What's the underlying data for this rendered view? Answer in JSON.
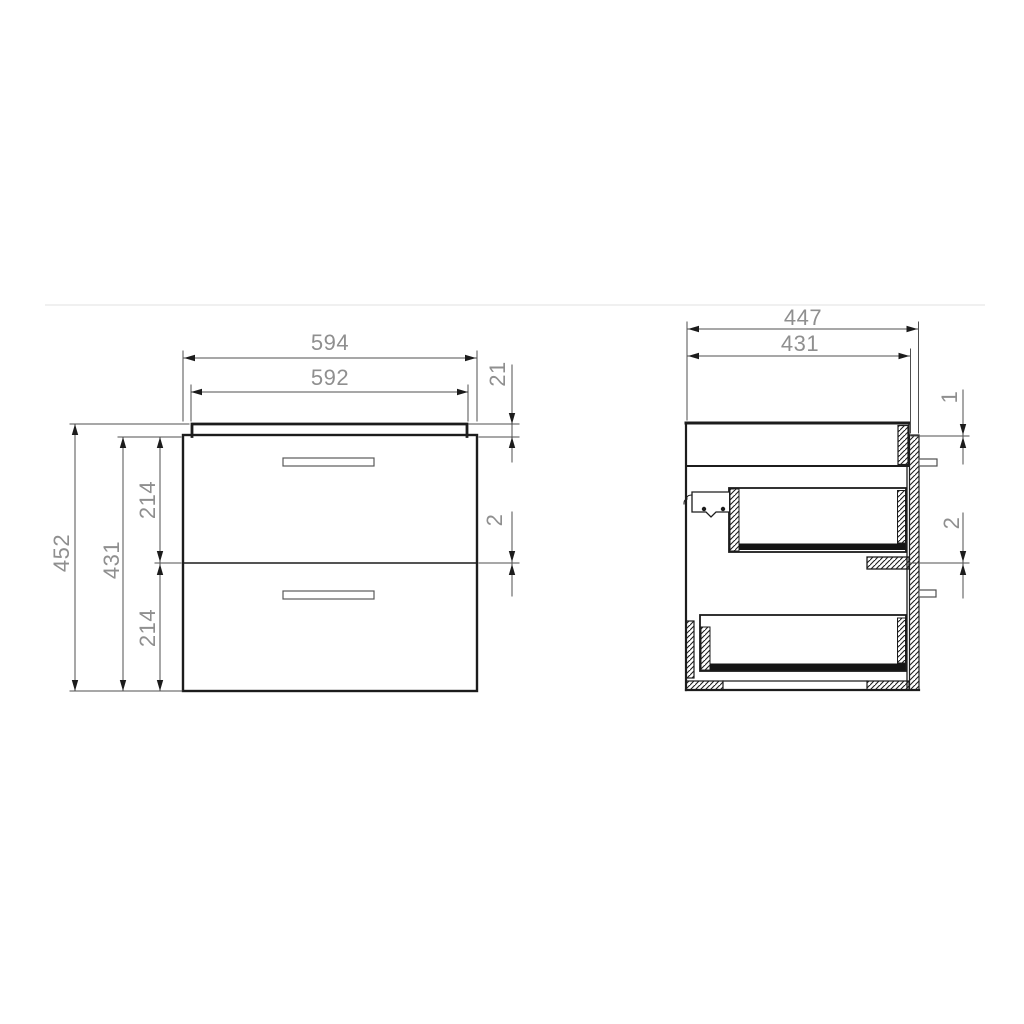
{
  "drawing": {
    "title": "two-drawer-cabinet-technical-drawing",
    "colors": {
      "outline": "#1c1c1c",
      "dim_line": "#4f4f4f",
      "dim_text": "#8f8f8f",
      "page_divider": "#f0f0f0",
      "background": "#ffffff"
    },
    "front_view": {
      "label": "front-view",
      "overall_width": "594",
      "top_panel_width": "592",
      "top_panel_height": "21",
      "drawer_gap": "2",
      "overall_height": "452",
      "carcass_height": "431",
      "upper_drawer_height": "214",
      "lower_drawer_height": "214"
    },
    "side_view": {
      "label": "side-view",
      "overall_depth": "447",
      "carcass_depth": "431",
      "back_panel_top_gap": "1",
      "runner_gap": "2"
    }
  }
}
